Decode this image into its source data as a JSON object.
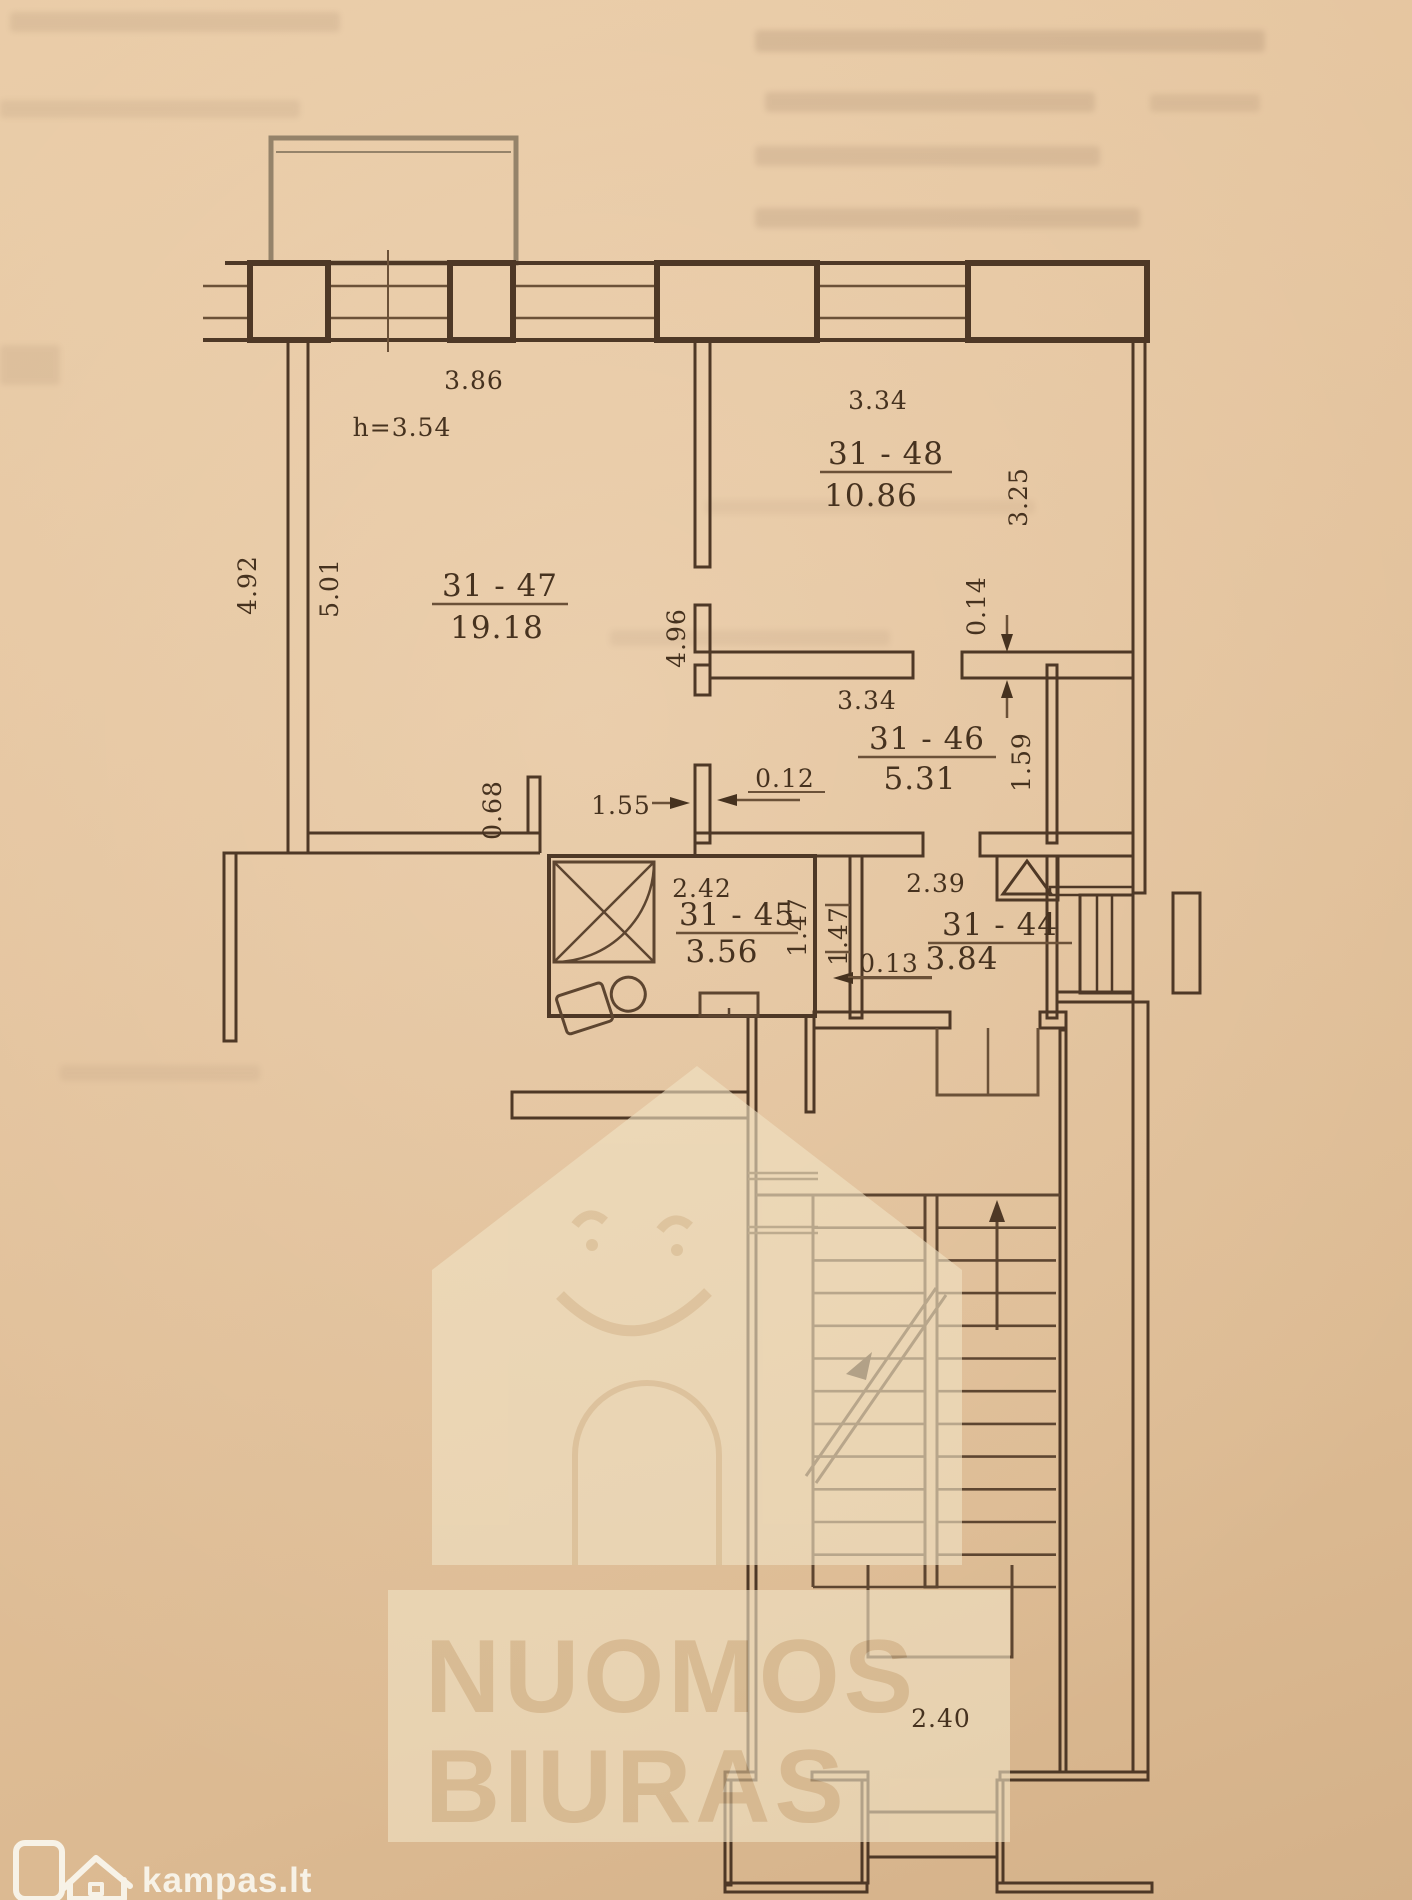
{
  "watermark": {
    "line1": "NUOMOS",
    "line2": "BIURAS"
  },
  "brand": {
    "site": "kampas.lt"
  },
  "plan": {
    "ceiling_height": "h=3.54",
    "rooms": [
      {
        "id": "31 - 47",
        "area": "19.18"
      },
      {
        "id": "31 - 48",
        "area": "10.86"
      },
      {
        "id": "31 - 46",
        "area": "5.31"
      },
      {
        "id": "31 - 45",
        "area": "3.56"
      },
      {
        "id": "31 - 44",
        "area": "3.84"
      }
    ],
    "dims": {
      "room47_width": "3.86",
      "room47_left_outer": "4.92",
      "room47_left_inner": "5.01",
      "room47_right": "4.96",
      "room47_stub": "0.68",
      "room47_door": "1.55",
      "wall_gap": "0.12",
      "room48_width": "3.34",
      "room48_right": "3.25",
      "wall_thickness": "0.14",
      "room46_width": "3.34",
      "room46_right": "1.59",
      "bath_width": "2.42",
      "bath_right": "1.47",
      "hall_left": "1.47",
      "hall_width": "2.39",
      "hall_gap": "0.13",
      "stairs_width": "2.40"
    }
  },
  "colors": {
    "paper": "#e3c29c",
    "line": "#4e3826",
    "watermark_panel": "#f0e2c4",
    "logo": "#f6f1e6"
  }
}
